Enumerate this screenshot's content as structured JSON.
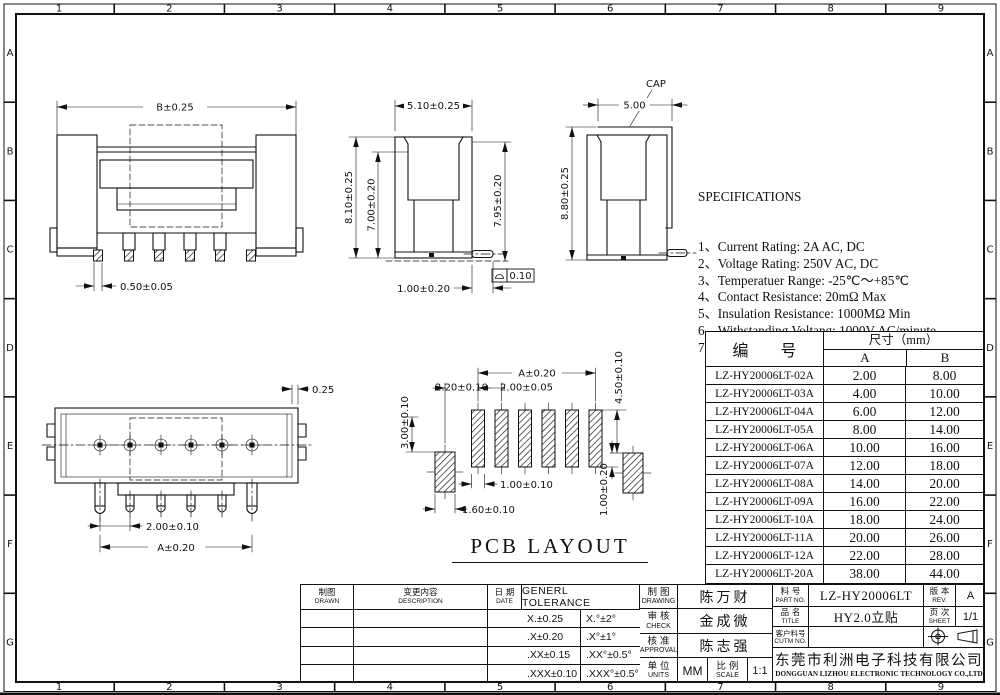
{
  "border": {
    "columns": [
      "1",
      "2",
      "3",
      "4",
      "5",
      "6",
      "7",
      "8",
      "9"
    ],
    "rows": [
      "A",
      "B",
      "C",
      "D",
      "E",
      "F",
      "G"
    ]
  },
  "dims": {
    "front_width": "B±0.25",
    "front_pin": "0.50±0.05",
    "side_top": "5.10±0.25",
    "side_left": "8.10±0.25",
    "side_inner": "7.00±0.20",
    "side_right": "7.95±0.20",
    "side_bottom": "1.00±0.20",
    "side_flatness": "0.10",
    "cap_label": "CAP",
    "cap_top": "5.00",
    "cap_left": "8.80±0.25",
    "top_offset": "0.25",
    "top_pitch": "2.00±0.10",
    "top_span": "A±0.20",
    "pad_span": "A±0.20",
    "pad_left_off": "2.20±0.10",
    "pad_pitch": "2.00±0.05",
    "pad_right_h": "4.50±0.10",
    "pad_left_h": "3.00±0.10",
    "pad_w": "1.00±0.10",
    "pad_side_w": "1.60±0.10",
    "pad_right_off": "1.00±0.20",
    "pcb_caption": "PCB LAYOUT"
  },
  "specs": {
    "title": "SPECIFICATIONS",
    "lines": [
      "1、Current Rating: 2A AC, DC",
      "2、Voltage Rating: 250V AC, DC",
      "3、Temperatuer Range: -25℃～+85℃",
      "4、Contact Resistance: 20mΩ Max",
      "5、Insulation Resistance: 1000MΩ Min",
      "6、Withstanding Voltang: 1000V AC/minute",
      "7、Material:Wafer LCP,UL94V-0",
      "    PIN Brass Tin-plated",
      "    Solder Phosphoric bronze Tin-plated"
    ]
  },
  "parts_table": {
    "header_part": "编 号",
    "header_size": "尺寸（mm）",
    "header_a": "A",
    "header_b": "B",
    "rows": [
      [
        "LZ-HY20006LT-02A",
        "2.00",
        "8.00"
      ],
      [
        "LZ-HY20006LT-03A",
        "4.00",
        "10.00"
      ],
      [
        "LZ-HY20006LT-04A",
        "6.00",
        "12.00"
      ],
      [
        "LZ-HY20006LT-05A",
        "8.00",
        "14.00"
      ],
      [
        "LZ-HY20006LT-06A",
        "10.00",
        "16.00"
      ],
      [
        "LZ-HY20006LT-07A",
        "12.00",
        "18.00"
      ],
      [
        "LZ-HY20006LT-08A",
        "14.00",
        "20.00"
      ],
      [
        "LZ-HY20006LT-09A",
        "16.00",
        "22.00"
      ],
      [
        "LZ-HY20006LT-10A",
        "18.00",
        "24.00"
      ],
      [
        "LZ-HY20006LT-11A",
        "20.00",
        "26.00"
      ],
      [
        "LZ-HY20006LT-12A",
        "22.00",
        "28.00"
      ],
      [
        "LZ-HY20006LT-20A",
        "38.00",
        "44.00"
      ]
    ]
  },
  "title_block": {
    "drawn_cn": "制图",
    "drawn_en": "DRAWN",
    "desc_cn": "变更内容",
    "desc_en": "DESCRIPTION",
    "date_cn": "日 期",
    "date_en": "DATE",
    "tol_title": "GENERL TOLERANCE",
    "tolerances": [
      [
        "X.±0.25",
        "X.°±2°"
      ],
      [
        ".X±0.20",
        ".X°±1°"
      ],
      [
        ".XX±0.15",
        ".XX°±0.5°"
      ],
      [
        ".XXX±0.10",
        ".XXX°±0.5°"
      ]
    ],
    "drawing_cn": "制 图",
    "drawing_en": "DRAWING",
    "drawing_name": "陈万财",
    "check_cn": "审 核",
    "check_en": "CHECK",
    "check_name": "金成微",
    "approval_cn": "核 准",
    "approval_en": "APPROVAL",
    "approval_name": "陈志强",
    "units_cn": "单 位",
    "units_en": "UNITS",
    "units_value": "MM",
    "scale_cn": "比 例",
    "scale_en": "SCALE",
    "scale_value": "1:1",
    "part_cn": "料 号",
    "part_en": "PART NO.",
    "part_value": "LZ-HY20006LT",
    "name_cn": "品 名",
    "name_en": "TITLE",
    "name_value": "HY2.0立贴",
    "cust_cn": "客户料号",
    "cust_en": "CUTM NO.",
    "cust_value": "",
    "rev_cn": "版 本",
    "rev_en": "REV.",
    "rev_value": "A",
    "sheet_cn": "页 次",
    "sheet_en": "SHEET",
    "sheet_value": "1/1",
    "company_cn": "东莞市利洲电子科技有限公司",
    "company_en": "DONGGUAN LIZHOU ELECTRONIC TECHNOLOGY CO.,LTD"
  }
}
